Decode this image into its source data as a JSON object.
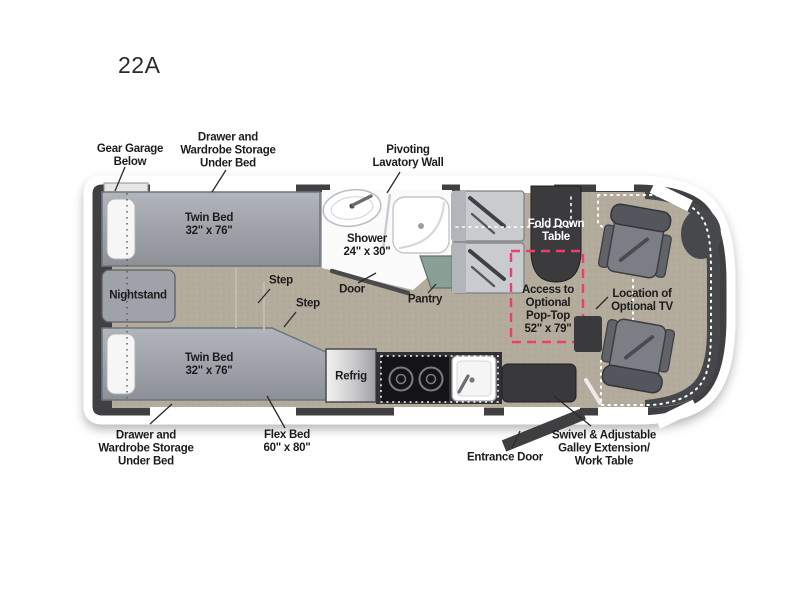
{
  "title": "22A",
  "floorplan": {
    "labels": {
      "gear_garage": "Gear Garage\nBelow",
      "drawer_storage_top": "Drawer and\nWardrobe Storage\nUnder Bed",
      "pivoting_lavatory_wall": "Pivoting\nLavatory Wall",
      "twin_bed_top": "Twin Bed\n32\" x 76\"",
      "shower": "Shower\n24\" x 30\"",
      "fold_down_table": "Fold Down\nTable",
      "nightstand": "Nightstand",
      "step_upper": "Step",
      "step_lower": "Step",
      "door": "Door",
      "pantry": "Pantry",
      "pop_top_access": "Access to\nOptional\nPop-Top\n52\" x 79\"",
      "optional_tv": "Location of\nOptional TV",
      "twin_bed_bottom": "Twin Bed\n32\" x 76\"",
      "refrigerator": "Refrig",
      "drawer_storage_bottom": "Drawer and\nWardrobe Storage\nUnder Bed",
      "flex_bed": "Flex Bed\n60\" x 80\"",
      "entrance_door": "Entrance Door",
      "galley_work_table": "Swivel & Adjustable\nGalley Extension/\nWork Table"
    },
    "colors": {
      "body_shell": "#404043",
      "interior_floor": "#b3ab9c",
      "pop_top_accent": "#ee3d72",
      "furniture_gray": "#9da1a8",
      "dark_fixture": "#39393b",
      "bathroom_white": "#fbfbfc",
      "pantry_green": "#8aa096",
      "window_white": "#ffffff"
    }
  }
}
